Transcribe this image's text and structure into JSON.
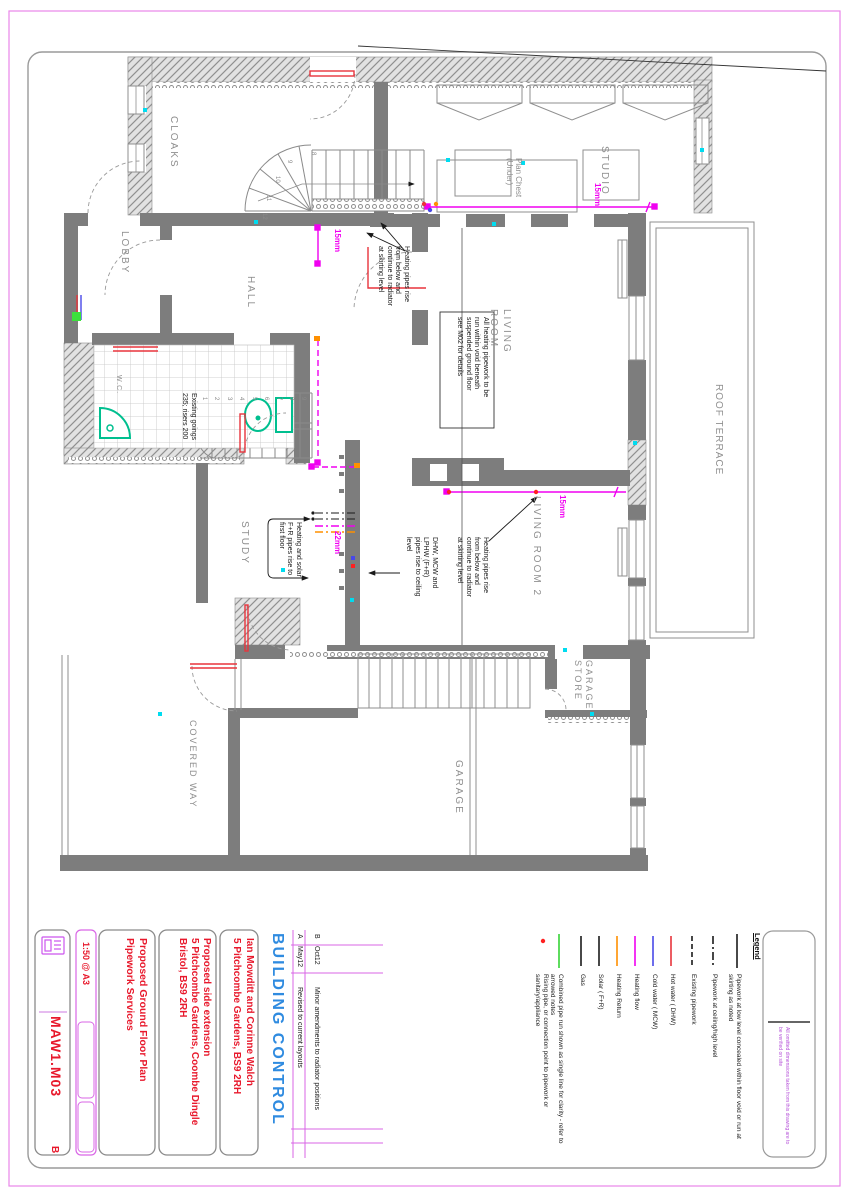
{
  "title_block": {
    "drawing_number": "MAW1.M03",
    "revision": "B",
    "scale": "1:50 @ A3",
    "title": "Proposed Ground Floor Plan\nPipework Services",
    "project": "Proposed side extension\n5 Pitchcombe Gardens, Coombe Dingle\nBristol, BS9 2RH",
    "client": "Ian Mowditt and Corinne Walch\n5 Pitchcombe Gardens, BS9 2RH",
    "stamp": "BUILDING CONTROL",
    "logo_icon": "drawing-stamp-icon",
    "disclaimer": "All omitted dimensions taken from this drawing are to\nbe verified on site"
  },
  "revisions": [
    {
      "rev": "B",
      "date": "Oct12",
      "note": "Minor amendments to radiator positions"
    },
    {
      "rev": "A",
      "date": "May12",
      "note": "Revised to current layouts"
    }
  ],
  "legend": {
    "heading": "Legend",
    "items": [
      {
        "label": "Pipework at low level concealed within floor void or run at\nskirting as noted",
        "style": "solid",
        "color": "#1a1a1a"
      },
      {
        "label": "Pipework at ceiling/high level",
        "style": "dashdot",
        "color": "#1a1a1a"
      },
      {
        "label": "Existing pipework",
        "style": "dashed",
        "color": "#1a1a1a"
      },
      {
        "label": "Hot water  ( DHW)",
        "style": "solid",
        "color": "#e8343c"
      },
      {
        "label": "Cold water  ( MCW)",
        "style": "solid",
        "color": "#4848e8"
      },
      {
        "label": "Heating flow",
        "style": "solid",
        "color": "#f000f0"
      },
      {
        "label": "Heating Return",
        "style": "solid",
        "color": "#ff9000"
      },
      {
        "label": "Solar  ( F+R)",
        "style": "solid",
        "color": "#1a1a1a"
      },
      {
        "label": "Gas",
        "style": "solid",
        "color": "#1a1a1a"
      },
      {
        "label": "Combined pipe run shown as single line for clarity - refer to\narrowed notes",
        "style": "solid",
        "color": "#35d435"
      },
      {
        "label": "Rising pipe, or connection point to pipework or\nsanitary/appliance",
        "style": "dot",
        "color": "#ff2020"
      }
    ]
  },
  "plan": {
    "rooms": {
      "cloaks": "CLOAKS",
      "lobby": "LOBBY",
      "hall": "HALL",
      "wc": "W.C.",
      "living": "LIVING\nROOM",
      "living2": "LIVING ROOM 2",
      "studio": "STUDIO",
      "roof_terrace": "ROOF TERRACE",
      "study": "STUDY",
      "garage_store": "GARAGE\nSTORE",
      "garage": "GARAGE",
      "covered_way": "COVERED WAY",
      "plan_chest": "Plan Chest\n(Under)"
    },
    "annotations": {
      "heating_rise_1": "Heating pipes rise\nfrom below and\ncontinue to radiator\nat skirting level",
      "void_note": "All heating pipework to be\nrun within void beneath\nsuspended ground floor\nsee M02 for details",
      "heating_rise_2": "Heating pipes rise\nfrom below and\ncontinue to radiator\nat skirting level",
      "dhw_note": "DHW, MCW and\nLPHW  (F+R)\npipes rise to ceiling\nlevel",
      "solar_note": "Heating and solar\nF+R pipes rise to\nfirst floor",
      "stair_note": "Existing goings\n235; risers 200"
    },
    "pipe_labels": {
      "l1": "15mm",
      "l2": "15mm",
      "l3": "15mm",
      "l4": "22mm"
    },
    "stairs": {
      "lower": [
        "1",
        "2",
        "3",
        "4",
        "5",
        "6",
        "7",
        "8",
        "9"
      ],
      "upper": [
        "8",
        "9",
        "10",
        "11",
        "12"
      ]
    }
  },
  "colors": {
    "sheet_border": "#ea86ea",
    "wall": "#7d7d7d",
    "heating_flow": "#f000f0",
    "hot_water": "#e8343c",
    "cold_water": "#4848e8",
    "heating_return": "#ff9000",
    "combined": "#35d435",
    "rising_point": "#ff2020",
    "marker_cyan": "#00dcf0",
    "title_red": "#e8192c",
    "violet": "#d966e6",
    "stamp_blue": "#2f8be0",
    "note_purple": "#b44fd8"
  }
}
